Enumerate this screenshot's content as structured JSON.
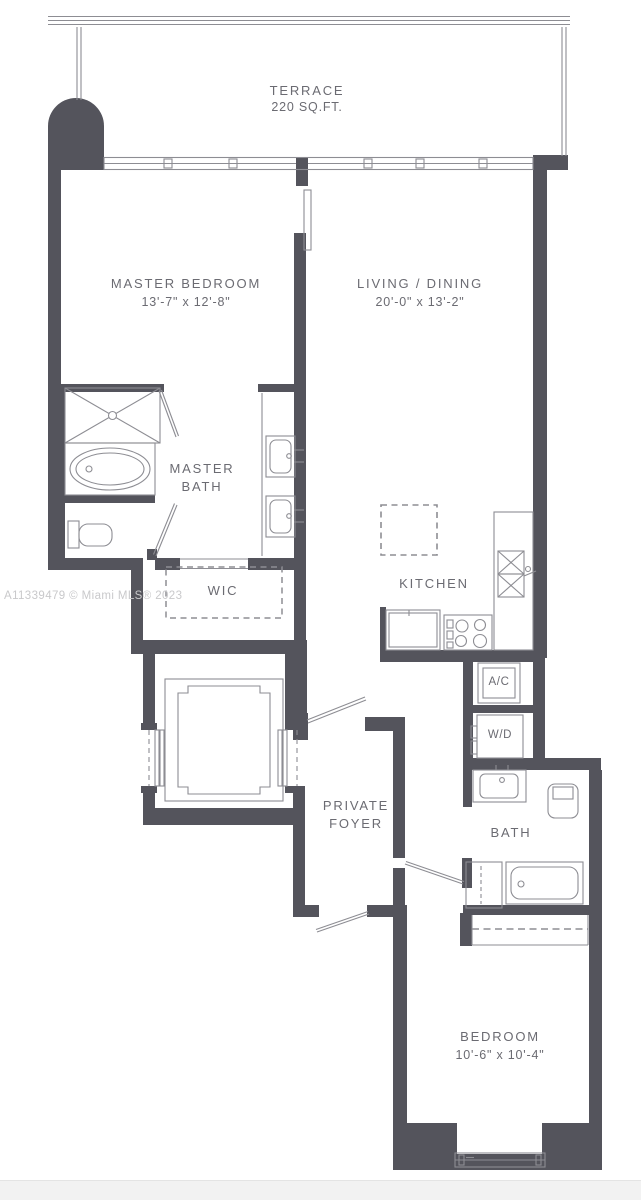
{
  "watermark": "A11339479 © Miami MLS® 2023",
  "labels": {
    "terrace": {
      "name": "TERRACE",
      "area": "220 SQ.FT."
    },
    "master_bedroom": {
      "name": "MASTER BEDROOM",
      "dims": "13'-7\" x 12'-8\""
    },
    "living_dining": {
      "name": "LIVING / DINING",
      "dims": "20'-0\" x 13'-2\""
    },
    "master_bath": {
      "line1": "MASTER",
      "line2": "BATH"
    },
    "wic": {
      "name": "WIC"
    },
    "kitchen": {
      "name": "KITCHEN"
    },
    "ac": {
      "name": "A/C"
    },
    "wd": {
      "name": "W/D"
    },
    "private_foyer": {
      "line1": "PRIVATE",
      "line2": "FOYER"
    },
    "bath": {
      "name": "BATH"
    },
    "bedroom": {
      "name": "BEDROOM",
      "dims": "10'-6\" x 10'-4\""
    }
  },
  "fixtures": [
    "shower-icon",
    "bathtub-icon",
    "toilet-icon",
    "double-vanity-icon",
    "sink-icon",
    "elevator-icon",
    "kitchen-island-icon",
    "refrigerator-icon",
    "stove-icon",
    "kitchen-sink-icon",
    "washer-dryer-icon",
    "closet-icon",
    "window-icon",
    "door-swing-icon"
  ],
  "colors": {
    "wall": "#54545c",
    "line": "#8d8d93",
    "text": "#6b6b72",
    "watermark": "#c9c9cb",
    "footer": "#f2f2f2",
    "background": "#ffffff"
  }
}
